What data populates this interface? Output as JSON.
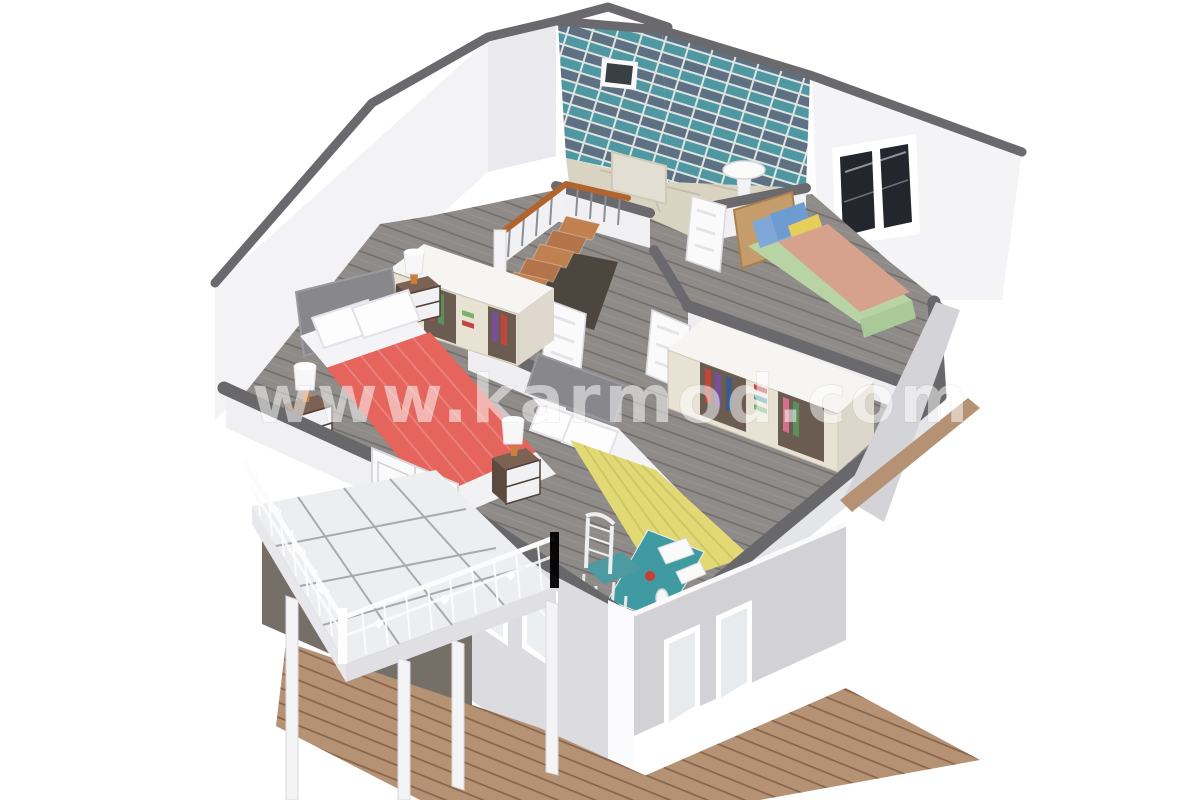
{
  "watermark": {
    "text": "www.karmod.com",
    "opacity": "0.52",
    "color": "#ffffff"
  },
  "scene": {
    "type": "3d-isometric-cutaway-render",
    "subject": "prefab two-storey house, upper floor plan view",
    "rooms": [
      {
        "name": "bathroom",
        "position": "back-center",
        "features": [
          "teal-striped-tile-walls",
          "small-wall-window",
          "pedestal-sink",
          "beige-tile-floor",
          "white-open-door"
        ]
      },
      {
        "name": "bedroom-right",
        "position": "back-right",
        "features": [
          "single-bed",
          "green-sheets",
          "salmon-blanket",
          "blue-pillows",
          "yellow-pillow",
          "wood-headboard",
          "dark-glass-window"
        ]
      },
      {
        "name": "bedroom-left",
        "position": "center-left",
        "features": [
          "double-bed",
          "coral-blanket",
          "gray-upholstered-headboard",
          "open-wardrobe-with-clothes",
          "two-nightstands-with-lamps"
        ]
      },
      {
        "name": "bedroom-middle",
        "position": "center-front",
        "features": [
          "double-bed",
          "yellow-blanket",
          "open-wardrobe-with-clothes",
          "nightstand-with-lamp",
          "teal-desk",
          "white-chair-teal-cushion"
        ]
      },
      {
        "name": "hallway",
        "position": "center",
        "features": [
          "l-shaped-staircase",
          "wood-handrail",
          "white-open-doors",
          "gray-plank-floor"
        ]
      },
      {
        "name": "balcony",
        "position": "front-left",
        "features": [
          "ornate-white-railing",
          "marble-tile-floor",
          "white-support-posts",
          "wood-deck-below"
        ]
      }
    ],
    "lower_floor": [
      "gray-walls",
      "white-trim-windows",
      "wrap-around-wood-deck",
      "dark-paving-pad"
    ]
  },
  "palette": {
    "background": "#ffffff",
    "wall_white": "#f3f3f6",
    "wall_cap_dark": "#6a6a6e",
    "floor_wood_gray": "#8e8b88",
    "bath_floor_beige": "#d9d3c2",
    "tile_teal": "#4f98a2",
    "tile_slate": "#5d7183",
    "coral": "#e5645c",
    "yellow": "#e2d975",
    "green_bed": "#b8d4a4",
    "salmon": "#d6a28b",
    "pillow_blue": "#7fa8d8",
    "pillow_yellow": "#e5cf5a",
    "headboard_gray": "#87878c",
    "headboard_wood": "#c59c6b",
    "stair_wood": "#b2642f",
    "desk_teal": "#3f9aa2",
    "chair_teal": "#4d9aa0",
    "deck_wood": "#b69274",
    "lower_wall_gray": "#d6d6da",
    "balcony_tile": "#edeef0",
    "nightstand_wood": "#7b6252",
    "lamp_base_orange": "#c87f3e"
  }
}
